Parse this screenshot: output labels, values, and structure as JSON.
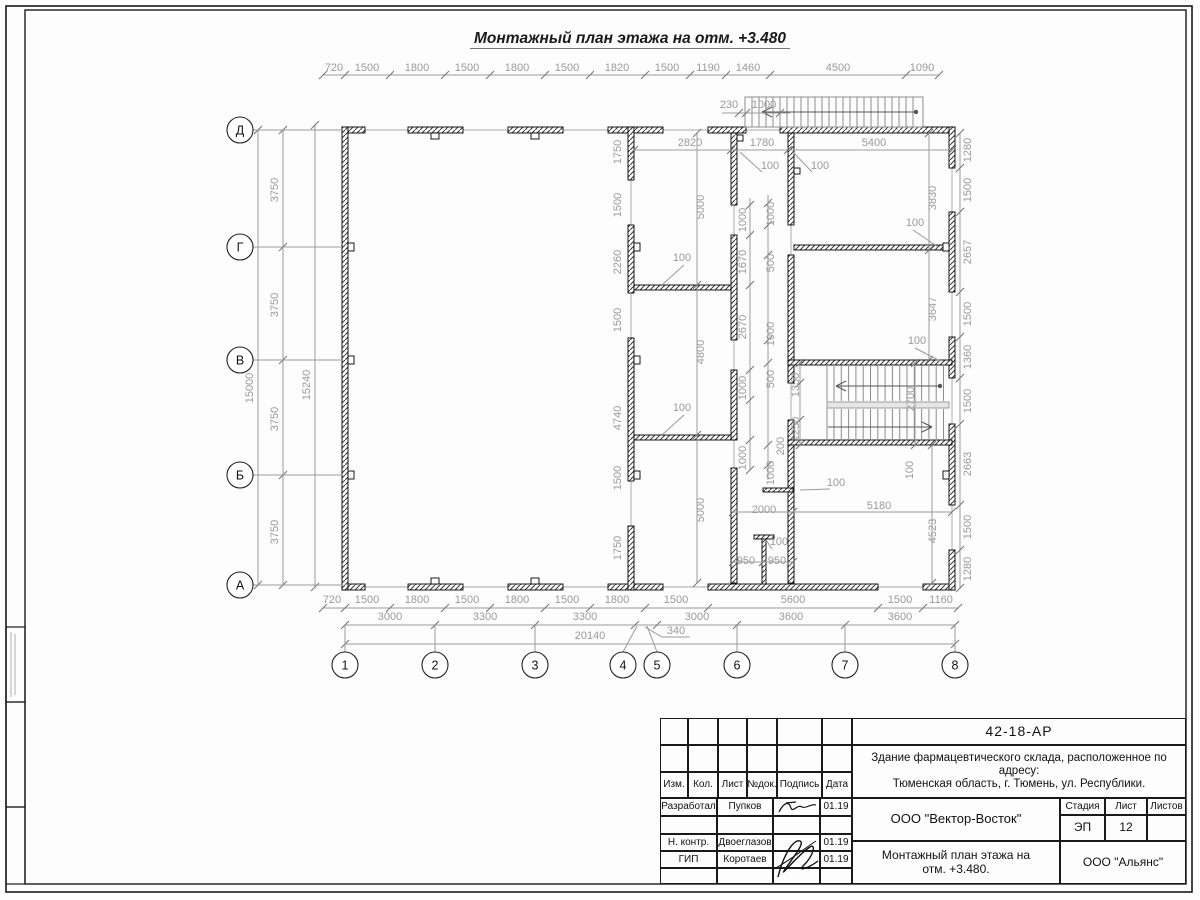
{
  "sheet": {
    "title": "Монтажный план этажа на отм. +3.480"
  },
  "axes": {
    "rows": [
      {
        "label": "Д",
        "x": 240,
        "y": 130
      },
      {
        "label": "Г",
        "x": 240,
        "y": 247
      },
      {
        "label": "В",
        "x": 240,
        "y": 360
      },
      {
        "label": "Б",
        "x": 240,
        "y": 475
      },
      {
        "label": "А",
        "x": 240,
        "y": 585
      }
    ],
    "cols": [
      {
        "label": "1",
        "x": 345,
        "y": 665
      },
      {
        "label": "2",
        "x": 435,
        "y": 665
      },
      {
        "label": "3",
        "x": 535,
        "y": 665
      },
      {
        "label": "4",
        "x": 623,
        "y": 665
      },
      {
        "label": "5",
        "x": 657,
        "y": 665
      },
      {
        "label": "6",
        "x": 737,
        "y": 665
      },
      {
        "label": "7",
        "x": 845,
        "y": 665
      },
      {
        "label": "8",
        "x": 955,
        "y": 665
      }
    ]
  },
  "dim_labels": [
    {
      "t": "720",
      "x": 334,
      "y": 71
    },
    {
      "t": "1500",
      "x": 367,
      "y": 71
    },
    {
      "t": "1800",
      "x": 417,
      "y": 71
    },
    {
      "t": "1500",
      "x": 467,
      "y": 71
    },
    {
      "t": "1800",
      "x": 517,
      "y": 71
    },
    {
      "t": "1500",
      "x": 567,
      "y": 71
    },
    {
      "t": "1820",
      "x": 617,
      "y": 71
    },
    {
      "t": "1500",
      "x": 667,
      "y": 71
    },
    {
      "t": "1190",
      "x": 708,
      "y": 71
    },
    {
      "t": "1460",
      "x": 748,
      "y": 71
    },
    {
      "t": "4500",
      "x": 838,
      "y": 71
    },
    {
      "t": "1090",
      "x": 922,
      "y": 71
    },
    {
      "t": "230",
      "x": 729,
      "y": 108
    },
    {
      "t": "1000",
      "x": 764,
      "y": 108
    },
    {
      "t": "720",
      "x": 332,
      "y": 603
    },
    {
      "t": "1500",
      "x": 367,
      "y": 603
    },
    {
      "t": "1800",
      "x": 417,
      "y": 603
    },
    {
      "t": "1500",
      "x": 467,
      "y": 603
    },
    {
      "t": "1800",
      "x": 517,
      "y": 603
    },
    {
      "t": "1500",
      "x": 567,
      "y": 603
    },
    {
      "t": "1800",
      "x": 617,
      "y": 603
    },
    {
      "t": "1500",
      "x": 676,
      "y": 603
    },
    {
      "t": "5600",
      "x": 793,
      "y": 603
    },
    {
      "t": "1500",
      "x": 900,
      "y": 603
    },
    {
      "t": "1160",
      "x": 941,
      "y": 603
    },
    {
      "t": "3000",
      "x": 390,
      "y": 620
    },
    {
      "t": "3300",
      "x": 485,
      "y": 620
    },
    {
      "t": "3300",
      "x": 585,
      "y": 620
    },
    {
      "t": "3000",
      "x": 697,
      "y": 620
    },
    {
      "t": "3600",
      "x": 791,
      "y": 620
    },
    {
      "t": "3600",
      "x": 900,
      "y": 620
    },
    {
      "t": "20140",
      "x": 590,
      "y": 639
    },
    {
      "t": "340",
      "x": 676,
      "y": 634
    },
    {
      "t": "3750",
      "x": 278,
      "y": 190,
      "r": 1
    },
    {
      "t": "3750",
      "x": 278,
      "y": 305,
      "r": 1
    },
    {
      "t": "3750",
      "x": 278,
      "y": 419,
      "r": 1
    },
    {
      "t": "3750",
      "x": 278,
      "y": 532,
      "r": 1
    },
    {
      "t": "15000",
      "x": 253,
      "y": 388,
      "r": 1
    },
    {
      "t": "15240",
      "x": 310,
      "y": 385,
      "r": 1
    },
    {
      "t": "1280",
      "x": 971,
      "y": 150,
      "r": 1
    },
    {
      "t": "1500",
      "x": 971,
      "y": 190,
      "r": 1
    },
    {
      "t": "2657",
      "x": 971,
      "y": 252,
      "r": 1
    },
    {
      "t": "1500",
      "x": 971,
      "y": 314,
      "r": 1
    },
    {
      "t": "1360",
      "x": 971,
      "y": 357,
      "r": 1
    },
    {
      "t": "1500",
      "x": 971,
      "y": 401,
      "r": 1
    },
    {
      "t": "2663",
      "x": 971,
      "y": 464,
      "r": 1
    },
    {
      "t": "1500",
      "x": 971,
      "y": 527,
      "r": 1
    },
    {
      "t": "1280",
      "x": 971,
      "y": 569,
      "r": 1
    },
    {
      "t": "2820",
      "x": 690,
      "y": 146
    },
    {
      "t": "1780",
      "x": 762,
      "y": 146
    },
    {
      "t": "5400",
      "x": 874,
      "y": 146
    },
    {
      "t": "100",
      "x": 770,
      "y": 169
    },
    {
      "t": "100",
      "x": 820,
      "y": 169
    },
    {
      "t": "1750",
      "x": 621,
      "y": 152,
      "r": 1
    },
    {
      "t": "1500",
      "x": 621,
      "y": 205,
      "r": 1
    },
    {
      "t": "2260",
      "x": 621,
      "y": 262,
      "r": 1
    },
    {
      "t": "1500",
      "x": 621,
      "y": 320,
      "r": 1
    },
    {
      "t": "4740",
      "x": 621,
      "y": 418,
      "r": 1
    },
    {
      "t": "1500",
      "x": 621,
      "y": 478,
      "r": 1
    },
    {
      "t": "1750",
      "x": 621,
      "y": 548,
      "r": 1
    },
    {
      "t": "5000",
      "x": 704,
      "y": 207,
      "r": 1
    },
    {
      "t": "4800",
      "x": 704,
      "y": 352,
      "r": 1
    },
    {
      "t": "5000",
      "x": 704,
      "y": 510,
      "r": 1
    },
    {
      "t": "1000",
      "x": 746,
      "y": 220,
      "r": 1
    },
    {
      "t": "1670",
      "x": 746,
      "y": 262,
      "r": 1
    },
    {
      "t": "2670",
      "x": 746,
      "y": 327,
      "r": 1
    },
    {
      "t": "1000",
      "x": 746,
      "y": 388,
      "r": 1
    },
    {
      "t": "1000",
      "x": 746,
      "y": 458,
      "r": 1
    },
    {
      "t": "1000",
      "x": 774,
      "y": 214,
      "r": 1
    },
    {
      "t": "500",
      "x": 774,
      "y": 263,
      "r": 1
    },
    {
      "t": "1000",
      "x": 774,
      "y": 334,
      "r": 1
    },
    {
      "t": "500",
      "x": 774,
      "y": 379,
      "r": 1
    },
    {
      "t": "200",
      "x": 784,
      "y": 446,
      "r": 1
    },
    {
      "t": "1000",
      "x": 774,
      "y": 473,
      "r": 1
    },
    {
      "t": "100",
      "x": 682,
      "y": 261
    },
    {
      "t": "100",
      "x": 682,
      "y": 411
    },
    {
      "t": "100",
      "x": 915,
      "y": 226
    },
    {
      "t": "100",
      "x": 917,
      "y": 344
    },
    {
      "t": "100",
      "x": 836,
      "y": 486
    },
    {
      "t": "100",
      "x": 779,
      "y": 545
    },
    {
      "t": "100",
      "x": 913,
      "y": 470,
      "r": 1
    },
    {
      "t": "1350",
      "x": 799,
      "y": 385,
      "r": 1
    },
    {
      "t": "1250",
      "x": 799,
      "y": 429,
      "r": 1
    },
    {
      "t": "2700",
      "x": 914,
      "y": 399,
      "r": 1
    },
    {
      "t": "3830",
      "x": 936,
      "y": 198,
      "r": 1
    },
    {
      "t": "3647",
      "x": 936,
      "y": 309,
      "r": 1
    },
    {
      "t": "4523",
      "x": 936,
      "y": 531,
      "r": 1
    },
    {
      "t": "2000",
      "x": 764,
      "y": 513
    },
    {
      "t": "5180",
      "x": 879,
      "y": 509
    },
    {
      "t": "950",
      "x": 746,
      "y": 564
    },
    {
      "t": "950",
      "x": 777,
      "y": 564
    }
  ],
  "titleblock": {
    "doc_code": "42-18-АР",
    "object_line1": "Здание фармацевтического склада, расположенное по адресу:",
    "object_line2": "Тюменская область, г. Тюмень, ул. Республики.",
    "designer_org": "ООО \"Вектор-Восток\"",
    "sheet_title_line1": "Монтажный план этажа на",
    "sheet_title_line2": "отм. +3.480.",
    "client_org": "ООО \"Альянс\"",
    "stage_label": "Стадия",
    "sheet_label": "Лист",
    "sheets_label": "Листов",
    "stage_value": "ЭП",
    "sheet_value": "12",
    "header_cols": [
      "Изм.",
      "Кол.",
      "Лист",
      "№док.",
      "Подпись",
      "Дата"
    ],
    "sign_rows": [
      {
        "role": "Разработал",
        "name": "Пупков",
        "date": "01.19"
      },
      {
        "role": "",
        "name": "",
        "date": ""
      },
      {
        "role": "Н. контр.",
        "name": "Двоеглазов",
        "date": "01.19"
      },
      {
        "role": "ГИП",
        "name": "Коротаев",
        "date": "01.19"
      }
    ]
  }
}
